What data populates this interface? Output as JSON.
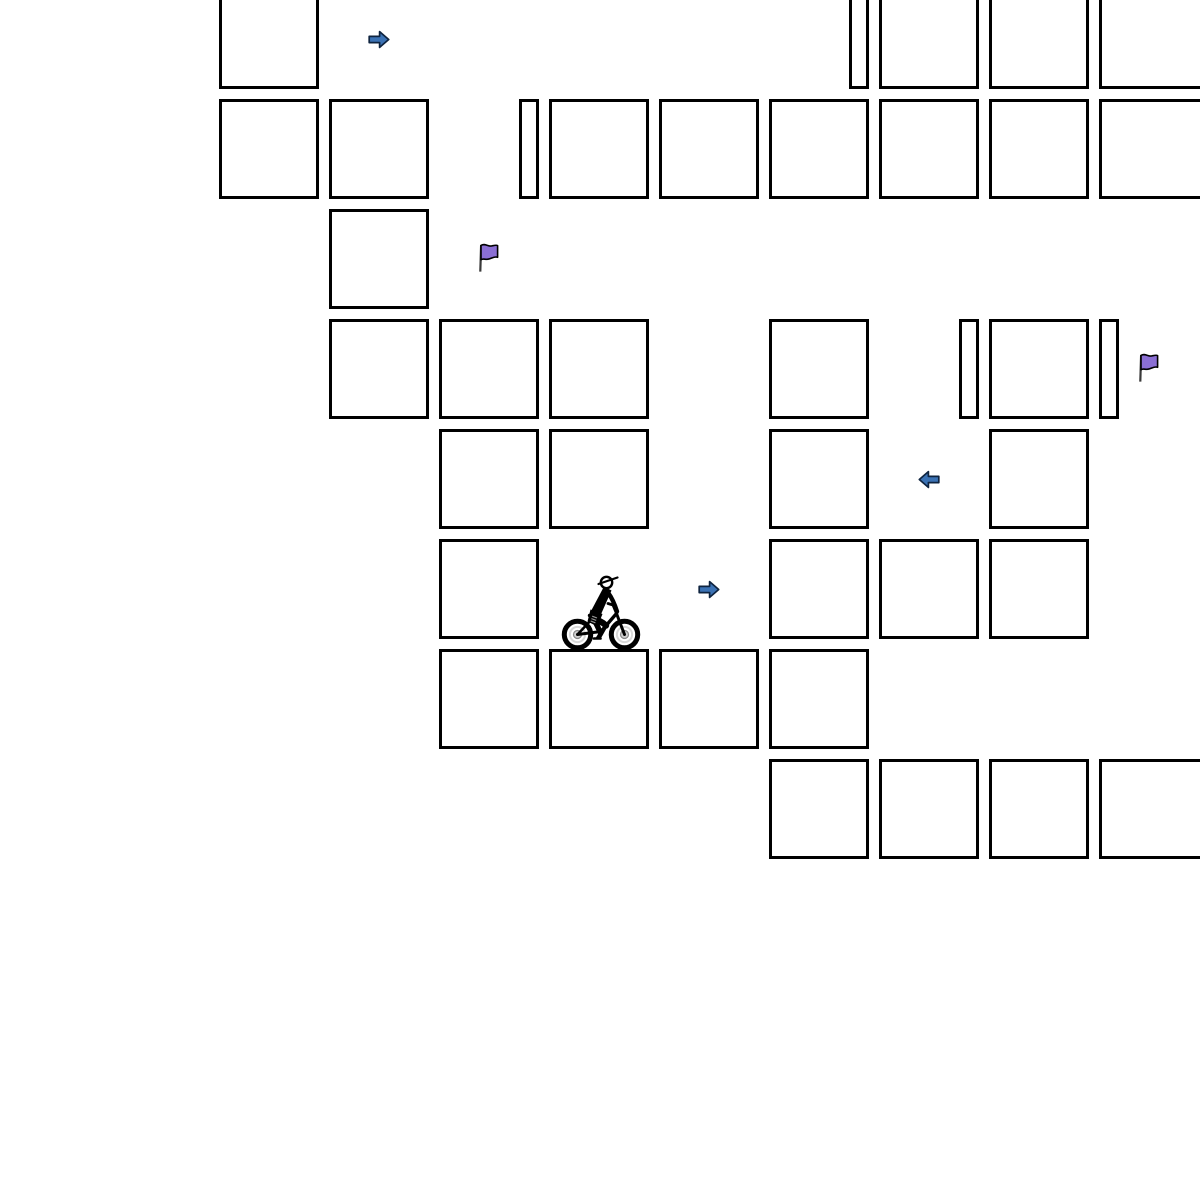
{
  "app": {
    "title": "grid cycling puzzle board"
  },
  "canvas": {
    "width": 1200,
    "height": 1200,
    "background": "#ffffff"
  },
  "palette": {
    "cell_fill": "#ffffff",
    "cell_border": "#000000",
    "arrow_fill": "#3b72b4",
    "arrow_stroke": "#0f2440",
    "flag_fill": "#8b6fd4",
    "flag_stroke": "#000000",
    "flag_pole": "#3a3a3a",
    "wheel_ring": "#d8d8d8",
    "wheel_hub": "#cfcfcf",
    "wheel_hub_edge": "#8a8a8a",
    "figure": "#000000"
  },
  "board": {
    "geometry": {
      "pitch": 110,
      "cell_size": 100,
      "narrow_width": 20,
      "origin_x": -1,
      "origin_y": -11,
      "border_width": 3,
      "clip_overflow_px": 8
    },
    "cells": [
      {
        "row": 0,
        "col": 2,
        "variant": "full"
      },
      {
        "row": 0,
        "col": 7,
        "variant": "narrow-right"
      },
      {
        "row": 0,
        "col": 8,
        "variant": "full"
      },
      {
        "row": 0,
        "col": 9,
        "variant": "full"
      },
      {
        "row": 0,
        "col": 10,
        "variant": "full",
        "cut_right": true
      },
      {
        "row": 1,
        "col": 2,
        "variant": "full"
      },
      {
        "row": 1,
        "col": 3,
        "variant": "full"
      },
      {
        "row": 1,
        "col": 4,
        "variant": "narrow-right"
      },
      {
        "row": 1,
        "col": 5,
        "variant": "full"
      },
      {
        "row": 1,
        "col": 6,
        "variant": "full"
      },
      {
        "row": 1,
        "col": 7,
        "variant": "full"
      },
      {
        "row": 1,
        "col": 8,
        "variant": "full"
      },
      {
        "row": 1,
        "col": 9,
        "variant": "full"
      },
      {
        "row": 1,
        "col": 10,
        "variant": "full",
        "cut_right": true
      },
      {
        "row": 2,
        "col": 3,
        "variant": "full"
      },
      {
        "row": 3,
        "col": 3,
        "variant": "full"
      },
      {
        "row": 3,
        "col": 4,
        "variant": "full"
      },
      {
        "row": 3,
        "col": 5,
        "variant": "full"
      },
      {
        "row": 3,
        "col": 7,
        "variant": "full"
      },
      {
        "row": 3,
        "col": 8,
        "variant": "narrow-right"
      },
      {
        "row": 3,
        "col": 9,
        "variant": "full"
      },
      {
        "row": 3,
        "col": 10,
        "variant": "narrow-left"
      },
      {
        "row": 4,
        "col": 4,
        "variant": "full"
      },
      {
        "row": 4,
        "col": 5,
        "variant": "full"
      },
      {
        "row": 4,
        "col": 7,
        "variant": "full"
      },
      {
        "row": 4,
        "col": 9,
        "variant": "full"
      },
      {
        "row": 5,
        "col": 4,
        "variant": "full"
      },
      {
        "row": 5,
        "col": 7,
        "variant": "full"
      },
      {
        "row": 5,
        "col": 8,
        "variant": "full"
      },
      {
        "row": 5,
        "col": 9,
        "variant": "full"
      },
      {
        "row": 6,
        "col": 4,
        "variant": "full"
      },
      {
        "row": 6,
        "col": 5,
        "variant": "full"
      },
      {
        "row": 6,
        "col": 6,
        "variant": "full"
      },
      {
        "row": 6,
        "col": 7,
        "variant": "full"
      },
      {
        "row": 7,
        "col": 7,
        "variant": "full"
      },
      {
        "row": 7,
        "col": 8,
        "variant": "full"
      },
      {
        "row": 7,
        "col": 9,
        "variant": "full"
      },
      {
        "row": 7,
        "col": 10,
        "variant": "full",
        "cut_right": true
      }
    ],
    "objects": [
      {
        "type": "arrow-right",
        "row": 0,
        "col": 3
      },
      {
        "type": "flag",
        "row": 2,
        "col": 4
      },
      {
        "type": "flag",
        "row": 3,
        "col": 10
      },
      {
        "type": "arrow-left",
        "row": 4,
        "col": 8
      },
      {
        "type": "arrow-right",
        "row": 5,
        "col": 6
      },
      {
        "type": "cyclist",
        "row": 5,
        "col": 5
      }
    ]
  }
}
